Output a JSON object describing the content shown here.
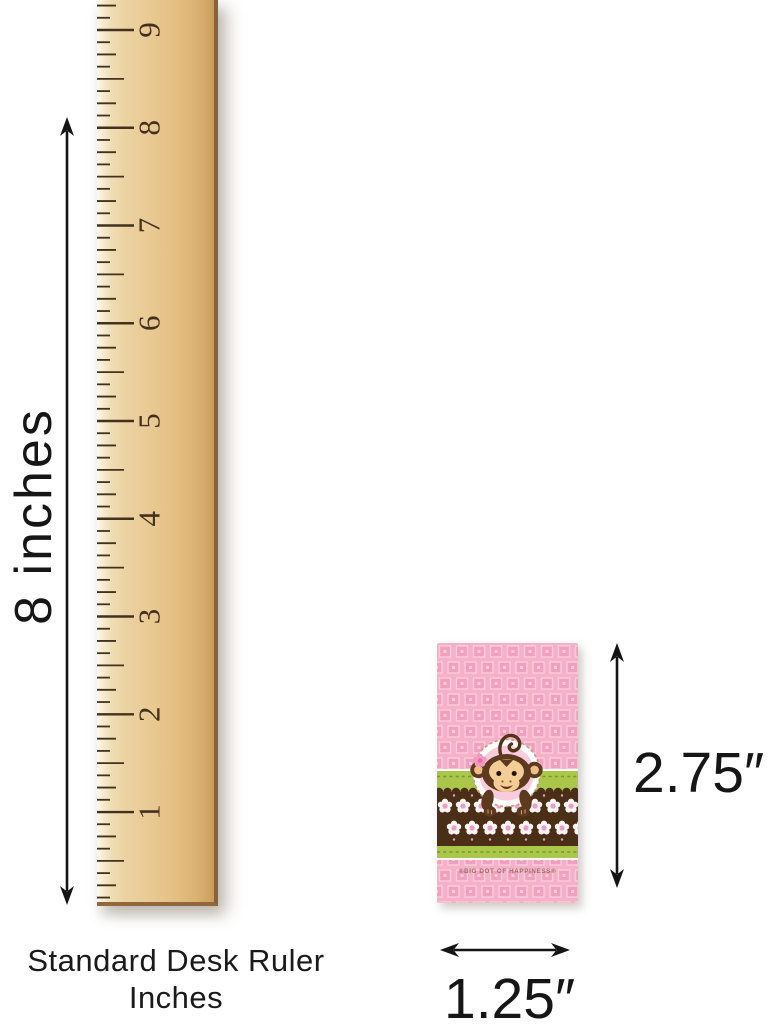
{
  "page": {
    "background": "#ffffff"
  },
  "ruler": {
    "numbers": [
      "9",
      "8",
      "7",
      "6",
      "5",
      "4",
      "3",
      "2",
      "1"
    ],
    "tick_color": "#42311f",
    "number_color": "#43311d",
    "wood_light": "#f6ecd2",
    "wood_dark": "#d0a463",
    "edge_color": "#8a6134"
  },
  "dimensions": {
    "height_label": "8 inches",
    "product_height_label": "2.75″",
    "product_width_label": "1.25″",
    "arrow_color": "#141414"
  },
  "caption": {
    "line1": "Standard Desk Ruler",
    "line2": "Inches"
  },
  "product": {
    "brand_text": "®BIG DOT OF HAPPINESS®",
    "base_pink": "#f6b0c8",
    "pattern_square": "#f1a0bd",
    "pattern_outline": "#f9cddd",
    "band_green": "#aac74b",
    "band_green_stitch": "#77972e",
    "band_brown": "#4b2e16",
    "flower_white": "#fdf4f6",
    "flower_center": "#ef9ec2",
    "emblem_ring": "#c59a7e",
    "emblem_fill": "#f9cbdc",
    "monkey_brown": "#5d3a1e",
    "monkey_tan": "#f4cd96",
    "flower_pink": "#f49ac2",
    "brand_color": "#9b6f63"
  }
}
